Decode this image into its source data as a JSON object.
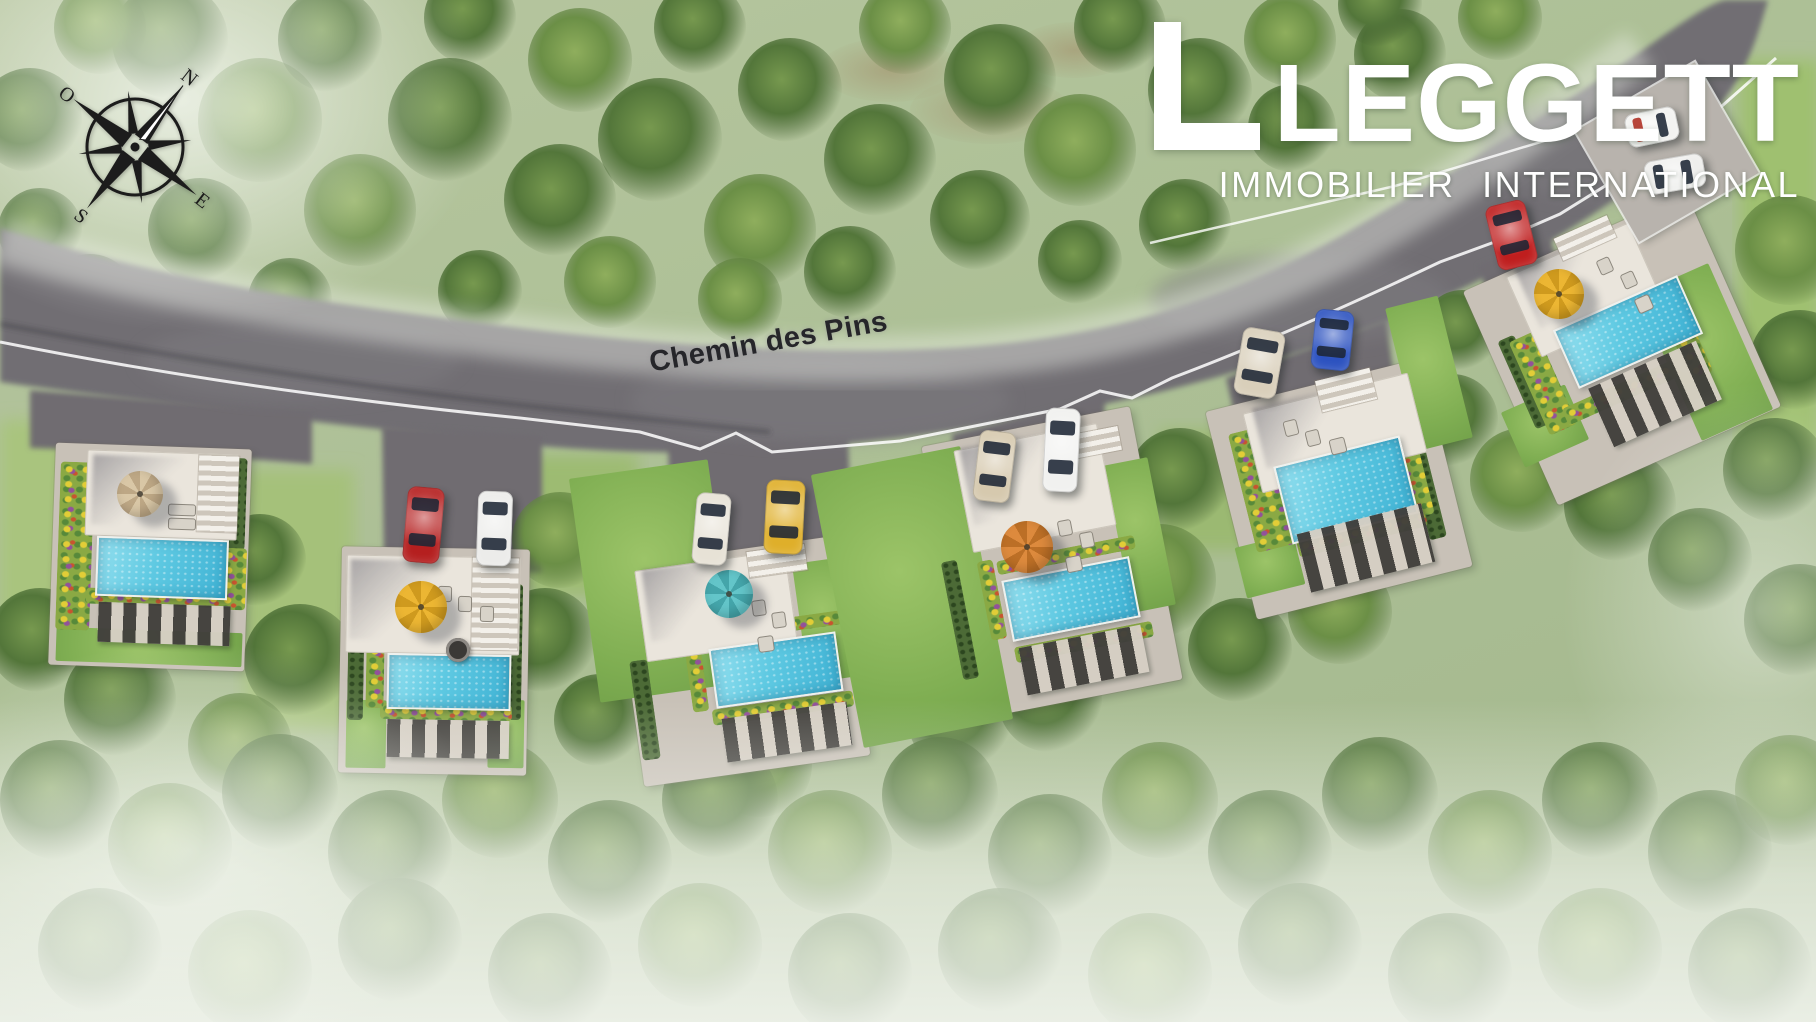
{
  "logo": {
    "name": "LEGGETT",
    "tagline": "IMMOBILIER INTERNATIONAL",
    "color": "#ffffff"
  },
  "compass": {
    "rotation_deg": 38,
    "directions": {
      "north": "N",
      "east": "E",
      "south": "S",
      "west": "O"
    }
  },
  "road": {
    "label": "Chemin des Pins",
    "label_x": 648,
    "label_y": 326,
    "label_rotation_deg": -10,
    "asphalt_color": "#716e73",
    "edge_line_color": "#ffffff",
    "label_color": "#26262a"
  },
  "palette": {
    "asphalt": "#716e73",
    "grass": "#aec399",
    "forest": "#4f7238",
    "pool_water": "#4fc0dc",
    "terrace": "#eae5dc",
    "path": "#c8c1b7",
    "flower_bed": "#8aa944",
    "hedge": "#4c6a36"
  },
  "site": {
    "villas": [
      {
        "id": 1,
        "rot": 2,
        "pad": {
          "x": 52,
          "y": 446,
          "w": 196,
          "h": 222
        },
        "gardens": [
          {
            "x": 56,
            "y": 630,
            "w": 186,
            "h": 34
          }
        ],
        "hedges": [
          {
            "x": 224,
            "y": 458,
            "w": 22,
            "h": 92
          }
        ],
        "flowers": [
          {
            "x": 58,
            "y": 462,
            "w": 34,
            "h": 168
          },
          {
            "x": 86,
            "y": 590,
            "w": 146,
            "h": 16
          },
          {
            "x": 220,
            "y": 548,
            "w": 26,
            "h": 62
          }
        ],
        "terrace": {
          "x": 86,
          "y": 452,
          "w": 152,
          "h": 86
        },
        "tshadow": {
          "x": 92,
          "y": 456,
          "w": 92,
          "h": 70
        },
        "stairs": {
          "x": 198,
          "y": 456,
          "w": 40,
          "h": 76
        },
        "pool": {
          "x": 96,
          "y": 538,
          "w": 128,
          "h": 56
        },
        "pergola": {
          "x": 98,
          "y": 604,
          "w": 132,
          "h": 40
        },
        "umbrella": {
          "cx": 140,
          "cy": 494,
          "r": 23,
          "color": "#d9c7a6",
          "shade": "#bda785"
        },
        "furn": [
          {
            "x": 168,
            "y": 504,
            "w": 26,
            "h": 10
          },
          {
            "x": 168,
            "y": 518,
            "w": 26,
            "h": 10
          }
        ]
      },
      {
        "id": 2,
        "rot": 1,
        "pad": {
          "x": 340,
          "y": 548,
          "w": 188,
          "h": 226
        },
        "gardens": [
          {
            "x": 346,
            "y": 700,
            "w": 40,
            "h": 68
          },
          {
            "x": 488,
            "y": 700,
            "w": 36,
            "h": 68
          }
        ],
        "hedges": [
          {
            "x": 348,
            "y": 584,
            "w": 16,
            "h": 136
          },
          {
            "x": 506,
            "y": 584,
            "w": 16,
            "h": 136
          }
        ],
        "flowers": [
          {
            "x": 380,
            "y": 704,
            "w": 132,
            "h": 16
          },
          {
            "x": 366,
            "y": 644,
            "w": 18,
            "h": 64
          }
        ],
        "terrace": {
          "x": 346,
          "y": 556,
          "w": 174,
          "h": 98
        },
        "tshadow": {
          "x": 350,
          "y": 560,
          "w": 100,
          "h": 80
        },
        "stairs": {
          "x": 472,
          "y": 558,
          "w": 46,
          "h": 92
        },
        "pool": {
          "x": 387,
          "y": 654,
          "w": 120,
          "h": 52
        },
        "pergola": {
          "x": 387,
          "y": 720,
          "w": 122,
          "h": 38
        },
        "umbrella": {
          "cx": 421,
          "cy": 607,
          "r": 26,
          "color": "#ecb633",
          "shade": "#cf9a1e"
        },
        "firepit": {
          "cx": 458,
          "cy": 650,
          "r": 12
        },
        "furn": [
          {
            "x": 438,
            "y": 586,
            "w": 12,
            "h": 14
          },
          {
            "x": 458,
            "y": 596,
            "w": 12,
            "h": 14
          },
          {
            "x": 480,
            "y": 606,
            "w": 12,
            "h": 14
          }
        ]
      },
      {
        "id": 3,
        "rot": -8,
        "pad": {
          "x": 628,
          "y": 550,
          "w": 228,
          "h": 222
        },
        "gardens": [
          {
            "x": 584,
            "y": 468,
            "w": 140,
            "h": 226
          },
          {
            "x": 800,
            "y": 560,
            "w": 52,
            "h": 120
          }
        ],
        "hedges": [
          {
            "x": 636,
            "y": 660,
            "w": 18,
            "h": 100
          }
        ],
        "flowers": [
          {
            "x": 700,
            "y": 620,
            "w": 142,
            "h": 14
          },
          {
            "x": 712,
            "y": 700,
            "w": 142,
            "h": 16
          },
          {
            "x": 688,
            "y": 634,
            "w": 16,
            "h": 78
          }
        ],
        "terrace": {
          "x": 640,
          "y": 560,
          "w": 152,
          "h": 92
        },
        "tshadow": {
          "x": 646,
          "y": 564,
          "w": 86,
          "h": 72
        },
        "stairs": {
          "x": 748,
          "y": 548,
          "w": 58,
          "h": 26
        },
        "pool": {
          "x": 712,
          "y": 640,
          "w": 124,
          "h": 56
        },
        "pergola": {
          "x": 724,
          "y": 710,
          "w": 126,
          "h": 44
        },
        "umbrella": {
          "cx": 729,
          "cy": 594,
          "r": 24,
          "color": "#63c5c9",
          "shade": "#44a5aa"
        },
        "furn": [
          {
            "x": 752,
            "y": 600,
            "w": 12,
            "h": 14
          },
          {
            "x": 772,
            "y": 612,
            "w": 12,
            "h": 14
          },
          {
            "x": 758,
            "y": 636,
            "w": 14,
            "h": 14
          }
        ]
      },
      {
        "id": 4,
        "rot": -11,
        "pad": {
          "x": 946,
          "y": 424,
          "w": 212,
          "h": 278
        },
        "gardens": [
          {
            "x": 836,
            "y": 458,
            "w": 152,
            "h": 278
          },
          {
            "x": 1118,
            "y": 460,
            "w": 44,
            "h": 150
          }
        ],
        "hedges": [
          {
            "x": 952,
            "y": 560,
            "w": 16,
            "h": 120
          }
        ],
        "flowers": [
          {
            "x": 996,
            "y": 548,
            "w": 140,
            "h": 14
          },
          {
            "x": 1014,
            "y": 634,
            "w": 140,
            "h": 16
          },
          {
            "x": 984,
            "y": 560,
            "w": 16,
            "h": 80
          }
        ],
        "terrace": {
          "x": 962,
          "y": 436,
          "w": 146,
          "h": 104
        },
        "tshadow": {
          "x": 966,
          "y": 440,
          "w": 88,
          "h": 78
        },
        "stairs": {
          "x": 1076,
          "y": 430,
          "w": 44,
          "h": 24
        },
        "pool": {
          "x": 1006,
          "y": 568,
          "w": 126,
          "h": 58
        },
        "pergola": {
          "x": 1022,
          "y": 636,
          "w": 124,
          "h": 48
        },
        "umbrella": {
          "cx": 1027,
          "cy": 547,
          "r": 26,
          "color": "#dd8a3d",
          "shade": "#bc6f26"
        },
        "furn": [
          {
            "x": 1058,
            "y": 520,
            "w": 12,
            "h": 14
          },
          {
            "x": 1080,
            "y": 532,
            "w": 12,
            "h": 14
          },
          {
            "x": 1066,
            "y": 556,
            "w": 14,
            "h": 14
          }
        ]
      },
      {
        "id": 5,
        "rot": -14,
        "pad": {
          "x": 1228,
          "y": 382,
          "w": 222,
          "h": 214
        },
        "gardens": [
          {
            "x": 1402,
            "y": 300,
            "w": 54,
            "h": 146
          },
          {
            "x": 1240,
            "y": 540,
            "w": 60,
            "h": 52
          }
        ],
        "hedges": [
          {
            "x": 1416,
            "y": 430,
            "w": 18,
            "h": 110
          }
        ],
        "flowers": [
          {
            "x": 1242,
            "y": 428,
            "w": 40,
            "h": 122
          },
          {
            "x": 1396,
            "y": 426,
            "w": 28,
            "h": 92
          },
          {
            "x": 1296,
            "y": 524,
            "w": 132,
            "h": 18
          }
        ],
        "terrace": {
          "x": 1250,
          "y": 392,
          "w": 170,
          "h": 82
        },
        "tshadow": {
          "x": 1258,
          "y": 396,
          "w": 96,
          "h": 62
        },
        "stairs": {
          "x": 1318,
          "y": 374,
          "w": 56,
          "h": 32
        },
        "pool": {
          "x": 1281,
          "y": 450,
          "w": 126,
          "h": 76
        },
        "pergola": {
          "x": 1302,
          "y": 518,
          "w": 128,
          "h": 60
        },
        "umbrella": null,
        "furn": [
          {
            "x": 1284,
            "y": 420,
            "w": 12,
            "h": 14
          },
          {
            "x": 1306,
            "y": 430,
            "w": 12,
            "h": 14
          },
          {
            "x": 1330,
            "y": 438,
            "w": 14,
            "h": 14
          }
        ]
      },
      {
        "id": 6,
        "rot": -24,
        "pad": {
          "x": 1500,
          "y": 232,
          "w": 244,
          "h": 234
        },
        "gardens": [
          {
            "x": 1666,
            "y": 272,
            "w": 78,
            "h": 160
          },
          {
            "x": 1510,
            "y": 396,
            "w": 70,
            "h": 60
          }
        ],
        "hedges": [
          {
            "x": 1516,
            "y": 334,
            "w": 18,
            "h": 96
          }
        ],
        "flowers": [
          {
            "x": 1528,
            "y": 332,
            "w": 30,
            "h": 102
          },
          {
            "x": 1560,
            "y": 384,
            "w": 120,
            "h": 18
          },
          {
            "x": 1672,
            "y": 290,
            "w": 24,
            "h": 90
          }
        ],
        "terrace": {
          "x": 1518,
          "y": 246,
          "w": 134,
          "h": 88
        },
        "tshadow": {
          "x": 1524,
          "y": 250,
          "w": 76,
          "h": 66
        },
        "stairs": {
          "x": 1556,
          "y": 226,
          "w": 58,
          "h": 24
        },
        "pool": {
          "x": 1560,
          "y": 300,
          "w": 132,
          "h": 60
        },
        "pergola": {
          "x": 1596,
          "y": 362,
          "w": 118,
          "h": 64
        },
        "umbrella": {
          "cx": 1559,
          "cy": 294,
          "r": 25,
          "color": "#ecb633",
          "shade": "#cf9a1e"
        },
        "furn": [
          {
            "x": 1598,
            "y": 258,
            "w": 12,
            "h": 14
          },
          {
            "x": 1622,
            "y": 272,
            "w": 12,
            "h": 14
          },
          {
            "x": 1636,
            "y": 296,
            "w": 14,
            "h": 14
          }
        ]
      }
    ],
    "parking_pad": {
      "x": 1598,
      "y": 88,
      "w": 138,
      "h": 128,
      "rot": -30
    },
    "cars": [
      {
        "name": "red-car-villa-2",
        "color": "#b51f1f",
        "x": 405,
        "y": 487,
        "w": 37,
        "h": 76,
        "rot": 5,
        "axis": "v"
      },
      {
        "name": "white-car-villa-2",
        "color": "#ececea",
        "x": 477,
        "y": 491,
        "w": 35,
        "h": 75,
        "rot": 2,
        "axis": "v"
      },
      {
        "name": "cream-car-villa-3",
        "color": "#e7e2d6",
        "x": 694,
        "y": 493,
        "w": 35,
        "h": 72,
        "rot": 5,
        "axis": "v"
      },
      {
        "name": "yellow-car-villa-3",
        "color": "#dfaf2a",
        "x": 765,
        "y": 480,
        "w": 39,
        "h": 74,
        "rot": 3,
        "axis": "v"
      },
      {
        "name": "beige-car-villa-4",
        "color": "#d6c9ae",
        "x": 976,
        "y": 431,
        "w": 37,
        "h": 71,
        "rot": 7,
        "axis": "v"
      },
      {
        "name": "white-car-villa-4",
        "color": "#f1f1ef",
        "x": 1044,
        "y": 408,
        "w": 35,
        "h": 84,
        "rot": 3,
        "axis": "v"
      },
      {
        "name": "champagne-car-villa-5",
        "color": "#d9cfba",
        "x": 1238,
        "y": 329,
        "w": 43,
        "h": 68,
        "rot": 10,
        "axis": "v"
      },
      {
        "name": "blue-car-villa-5",
        "color": "#2c52c0",
        "x": 1313,
        "y": 310,
        "w": 39,
        "h": 60,
        "rot": 6,
        "axis": "v"
      },
      {
        "name": "red-car-villa-6",
        "color": "#bf1e1e",
        "x": 1491,
        "y": 202,
        "w": 41,
        "h": 66,
        "rot": -14,
        "axis": "v"
      },
      {
        "name": "white-car-parking-1",
        "color": "#f3f3f1",
        "x": 1626,
        "y": 110,
        "w": 52,
        "h": 34,
        "rot": -12,
        "axis": "h",
        "glass": "#b8453a"
      },
      {
        "name": "white-car-parking-2",
        "color": "#efefed",
        "x": 1645,
        "y": 157,
        "w": 60,
        "h": 34,
        "rot": -10,
        "axis": "h"
      }
    ]
  }
}
